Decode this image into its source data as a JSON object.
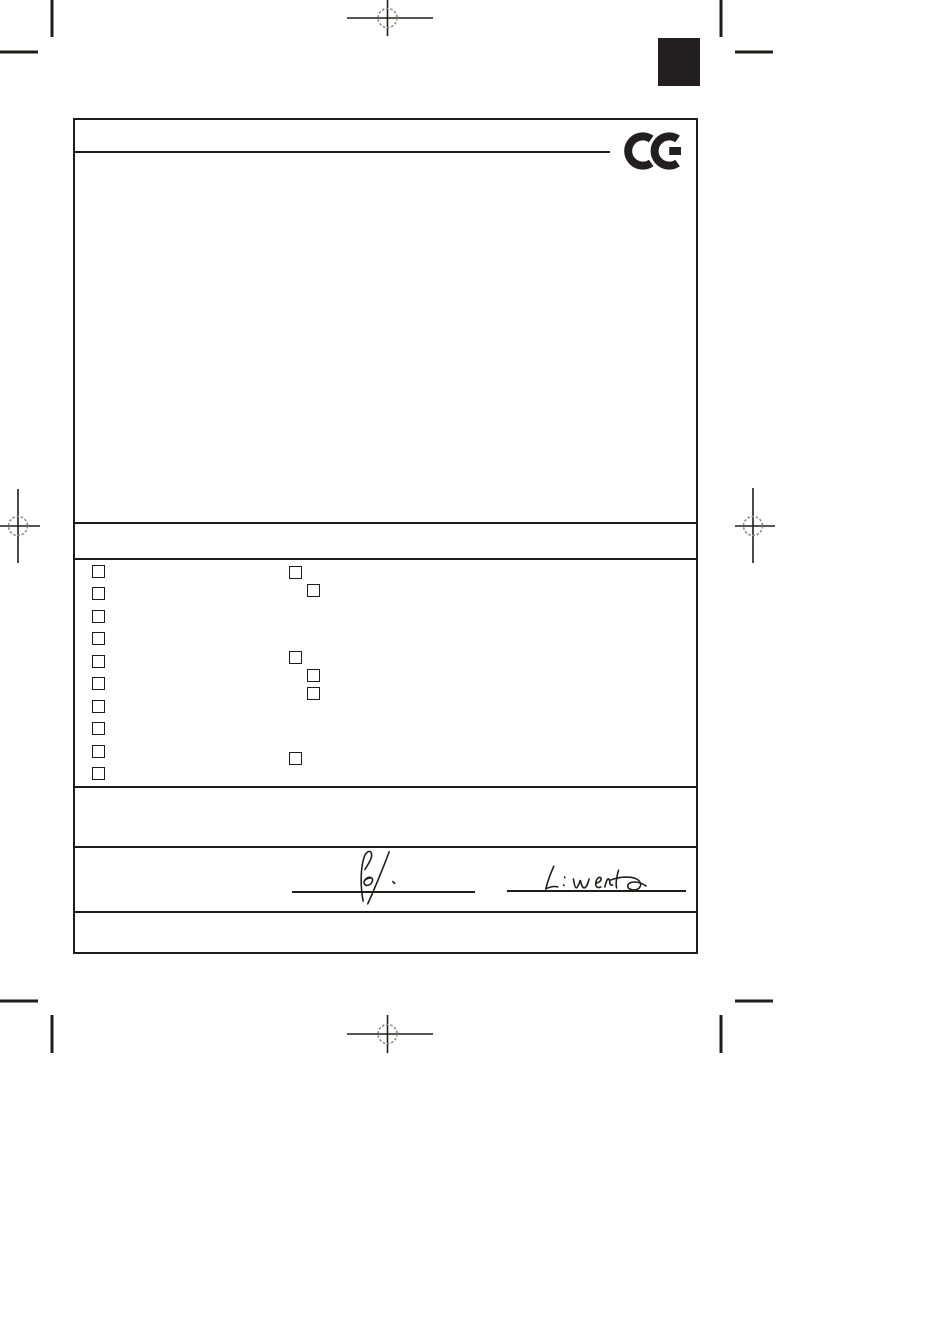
{
  "document": {
    "description": "blank scanned declaration form page",
    "visible_text": "",
    "ce_mark": {
      "label": "CE",
      "color": "#231f20"
    }
  },
  "colors": {
    "ink": "#1d1d1b",
    "registration_gray": "#8c8c8c",
    "page_background": "#ffffff",
    "registration_block": "#231f20"
  },
  "checkboxes": {
    "left_column": [
      {
        "checked": false
      },
      {
        "checked": false
      },
      {
        "checked": false
      },
      {
        "checked": false
      },
      {
        "checked": false
      },
      {
        "checked": false
      },
      {
        "checked": false
      },
      {
        "checked": false
      },
      {
        "checked": false
      },
      {
        "checked": false
      }
    ],
    "middle_column": [
      {
        "checked": false
      },
      {
        "checked": false
      },
      {
        "checked": false
      },
      {
        "checked": false
      },
      {
        "checked": false
      },
      {
        "checked": false
      }
    ]
  },
  "signatures": [
    {
      "style": "handwritten",
      "position": "left"
    },
    {
      "style": "handwritten",
      "position": "right"
    }
  ]
}
